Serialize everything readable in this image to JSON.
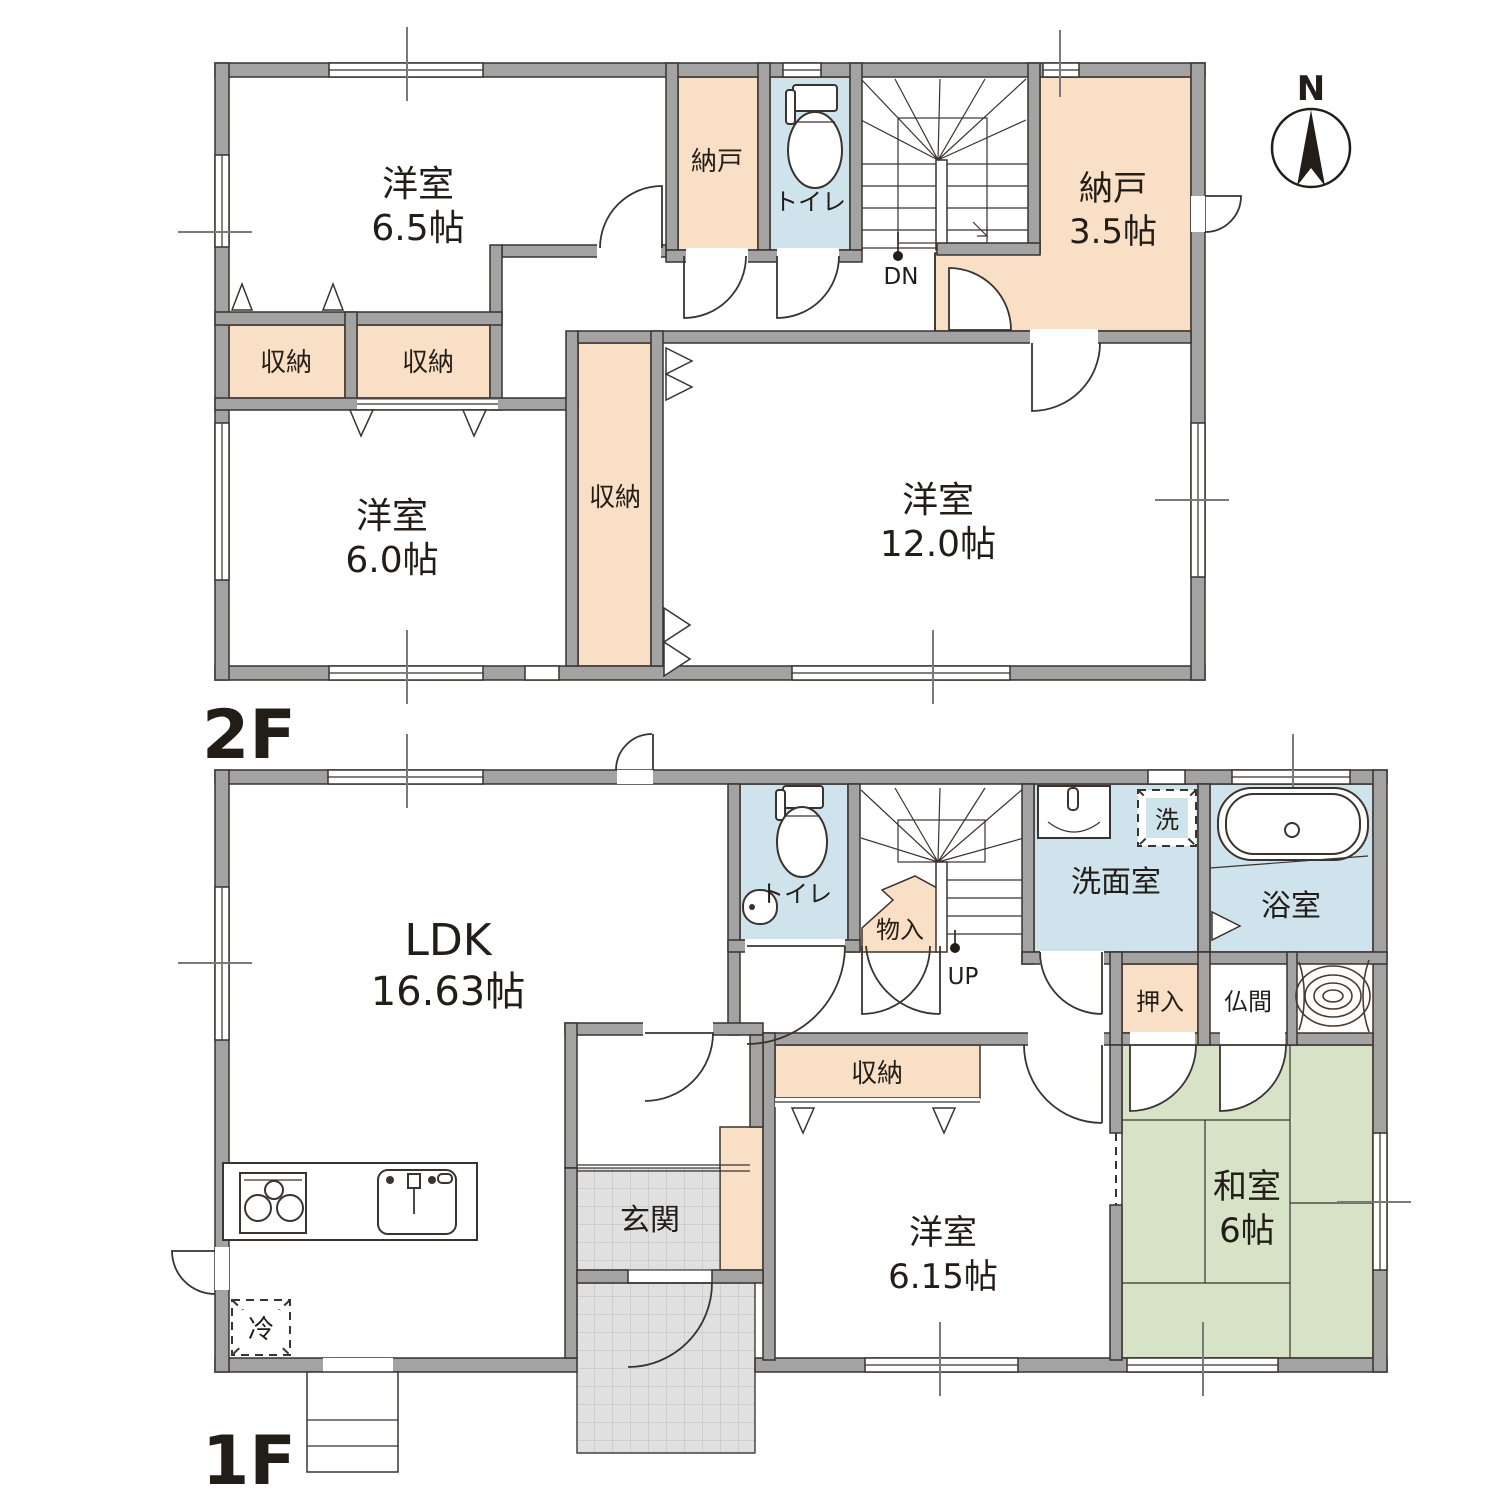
{
  "colors": {
    "storage_fill": "#f8dfc5",
    "wet_area_fill": "#cfe3ed",
    "tatami_fill": "#d6e3c7",
    "wall_fill": "#a3a3a3",
    "outline": "#3b332e",
    "tile_fill": "#e0e0e0"
  },
  "compass": {
    "label": "N"
  },
  "floor_2f": {
    "label": "2F",
    "stair_direction": "DN",
    "rooms": {
      "yoshitsu_65": {
        "name": "洋室",
        "size": "6.5帖"
      },
      "nando_small": {
        "name": "納戸"
      },
      "toilet": {
        "name": "トイレ"
      },
      "nando_35": {
        "name": "納戸",
        "size": "3.5帖"
      },
      "shuno_left": {
        "name": "収納"
      },
      "shuno_mid": {
        "name": "収納"
      },
      "yoshitsu_60": {
        "name": "洋室",
        "size": "6.0帖"
      },
      "shuno_tall": {
        "name": "収納"
      },
      "yoshitsu_120": {
        "name": "洋室",
        "size": "12.0帖"
      }
    }
  },
  "floor_1f": {
    "label": "1F",
    "stair_direction": "UP",
    "rooms": {
      "ldk": {
        "name": "LDK",
        "size": "16.63帖"
      },
      "toilet": {
        "name": "トイレ"
      },
      "monoire": {
        "name": "物入"
      },
      "senmen": {
        "name": "洗面室"
      },
      "washer": {
        "name": "洗"
      },
      "bath": {
        "name": "浴室"
      },
      "oshiire": {
        "name": "押入"
      },
      "butsuma": {
        "name": "仏間"
      },
      "washitsu": {
        "name": "和室",
        "size": "6帖"
      },
      "shuno": {
        "name": "収納"
      },
      "genkan": {
        "name": "玄関"
      },
      "yoshitsu_615": {
        "name": "洋室",
        "size": "6.15帖"
      },
      "fridge": {
        "name": "冷"
      }
    }
  }
}
